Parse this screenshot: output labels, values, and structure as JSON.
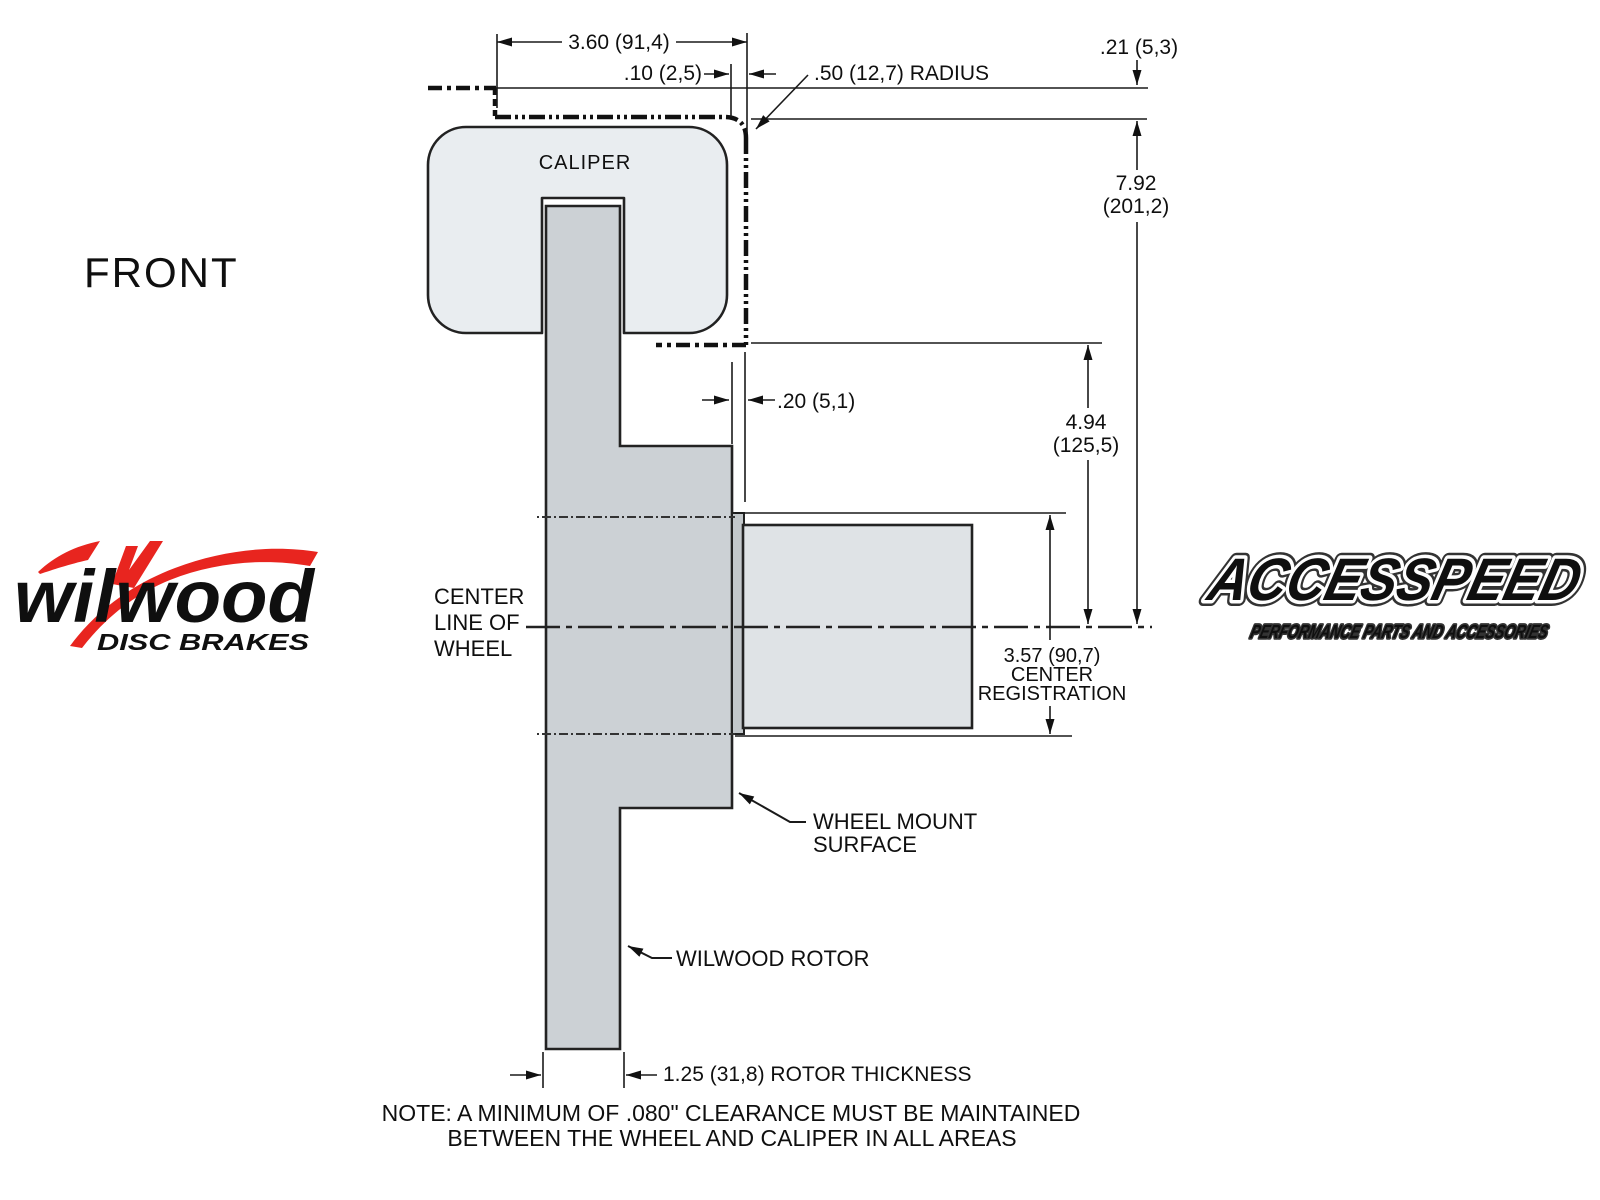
{
  "view_label": "FRONT",
  "caliper_label": "CALIPER",
  "centerline": {
    "l1": "CENTER",
    "l2": "LINE OF",
    "l3": "WHEEL"
  },
  "dims": {
    "d360": "3.60 (91,4)",
    "d10": ".10 (2,5)",
    "d50": ".50 (12,7) RADIUS",
    "d21": ".21 (5,3)",
    "d792a": "7.92",
    "d792b": "(201,2)",
    "d494a": "4.94",
    "d494b": "(125,5)",
    "d20": ".20 (5,1)",
    "d357a": "3.57 (90,7)",
    "d357b": "CENTER",
    "d357c": "REGISTRATION",
    "d125": "1.25 (31,8) ROTOR THICKNESS"
  },
  "callouts": {
    "wheel_mount_l1": "WHEEL MOUNT",
    "wheel_mount_l2": "SURFACE",
    "rotor": "WILWOOD ROTOR"
  },
  "note": {
    "l1": "NOTE: A MINIMUM OF .080\" CLEARANCE MUST BE MAINTAINED",
    "l2": "BETWEEN THE WHEEL AND CALIPER IN ALL AREAS"
  },
  "logos": {
    "wilwood": {
      "wordmark": "wilwood",
      "tagline": "DISC BRAKES",
      "red": "#e8251f",
      "black": "#111111"
    },
    "accesspeed": {
      "wordmark": "ACCESSPEED",
      "tagline": "PERFORMANCE PARTS AND ACCESSORIES"
    }
  },
  "colors": {
    "caliper_fill": "#e9edf0",
    "rotor_fill": "#ccd1d5",
    "pilot_fill": "#c2c7ca",
    "hub_fill": "#dfe3e6",
    "line": "#1a1a1a"
  }
}
